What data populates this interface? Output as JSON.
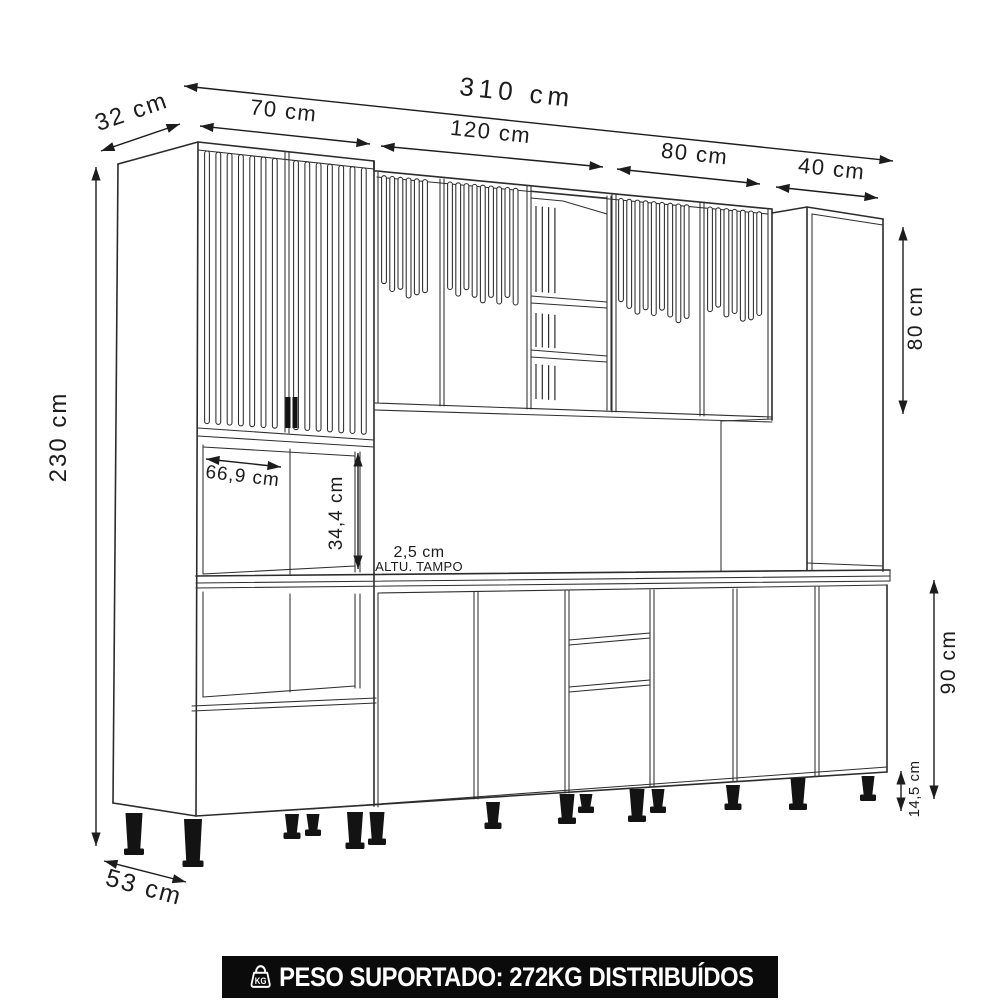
{
  "drawing": {
    "type": "kitchen-cabinet-technical-drawing",
    "dimensions": {
      "total_width": "310 cm",
      "top_depth": "32 cm",
      "left_section_width": "70 cm",
      "mid_section_width": "120 cm",
      "right_section_width": "80 cm",
      "tall_right_width": "40 cm",
      "total_height": "230 cm",
      "upper_cabinet_height": "80 cm",
      "niche_width": "66,9 cm",
      "niche_height": "34,4 cm",
      "countertop_thickness": "2,5 cm",
      "countertop_caption": "ALTU. TAMPO",
      "base_height": "90 cm",
      "feet_height": "14,5 cm",
      "base_depth": "53 cm"
    },
    "colors": {
      "line": "#2b2b2b",
      "black_parts": "#131313",
      "background": "#ffffff",
      "banner_bg": "#0b0b0b",
      "banner_text": "#ffffff"
    }
  },
  "banner": {
    "icon": "kg-weight-icon",
    "kg_label": "KG",
    "text": "PESO SUPORTADO: 272KG DISTRIBUÍDOS"
  }
}
